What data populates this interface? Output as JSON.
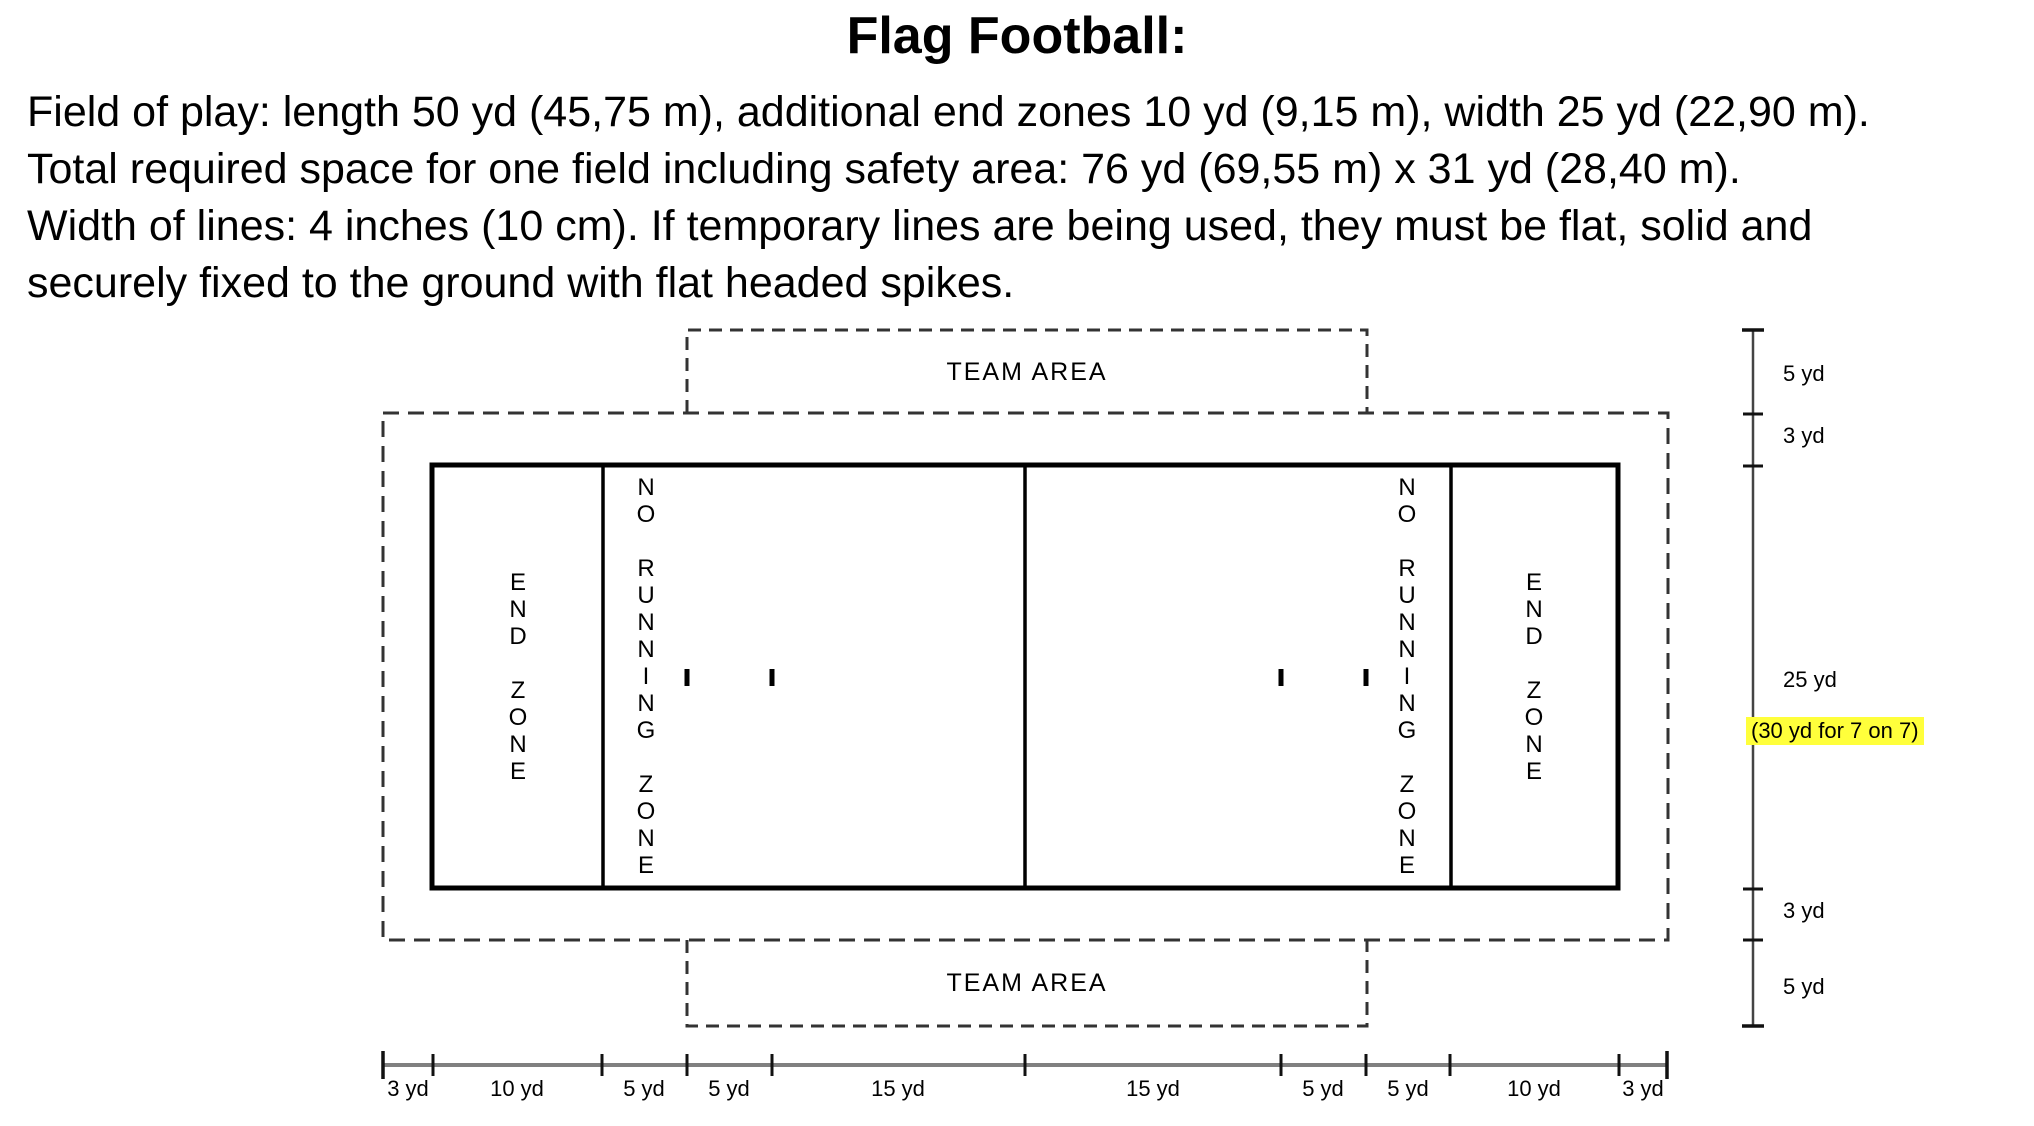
{
  "title": "Flag Football:",
  "intro_lines": [
    "Field of play: length 50 yd (45,75 m), additional end zones 10 yd (9,15 m), width 25 yd (22,90 m).",
    "Total required space for one field including safety area: 76 yd (69,55 m) x 31 yd (28,40 m).",
    "Width of lines: 4 inches (10 cm). If temporary lines are being used, they must be flat, solid and",
    "securely fixed to the ground with flat headed spikes."
  ],
  "diagram": {
    "team_area_top_label": "TEAM AREA",
    "team_area_bottom_label": "TEAM AREA",
    "end_zone_label": "END ZONE",
    "no_running_zone_label": "NO RUNNING ZONE",
    "vertical_ruler": {
      "labels": [
        {
          "text": "5 yd",
          "highlight": false
        },
        {
          "text": "3 yd",
          "highlight": false
        },
        {
          "text": "25 yd",
          "highlight": false
        },
        {
          "text": "(30 yd for 7 on 7)",
          "highlight": true
        },
        {
          "text": "3 yd",
          "highlight": false
        },
        {
          "text": "5 yd",
          "highlight": false
        }
      ]
    },
    "bottom_ruler": {
      "segment_labels": [
        "3 yd",
        "10 yd",
        "5 yd",
        "5 yd",
        "15 yd",
        "15 yd",
        "5 yd",
        "5 yd",
        "10 yd",
        "3 yd"
      ]
    },
    "colors": {
      "highlight": "#ffff3b",
      "field_line": "#000000",
      "dashed_line": "#333333",
      "ruler_line": "#808080",
      "tick": "#111111"
    }
  }
}
